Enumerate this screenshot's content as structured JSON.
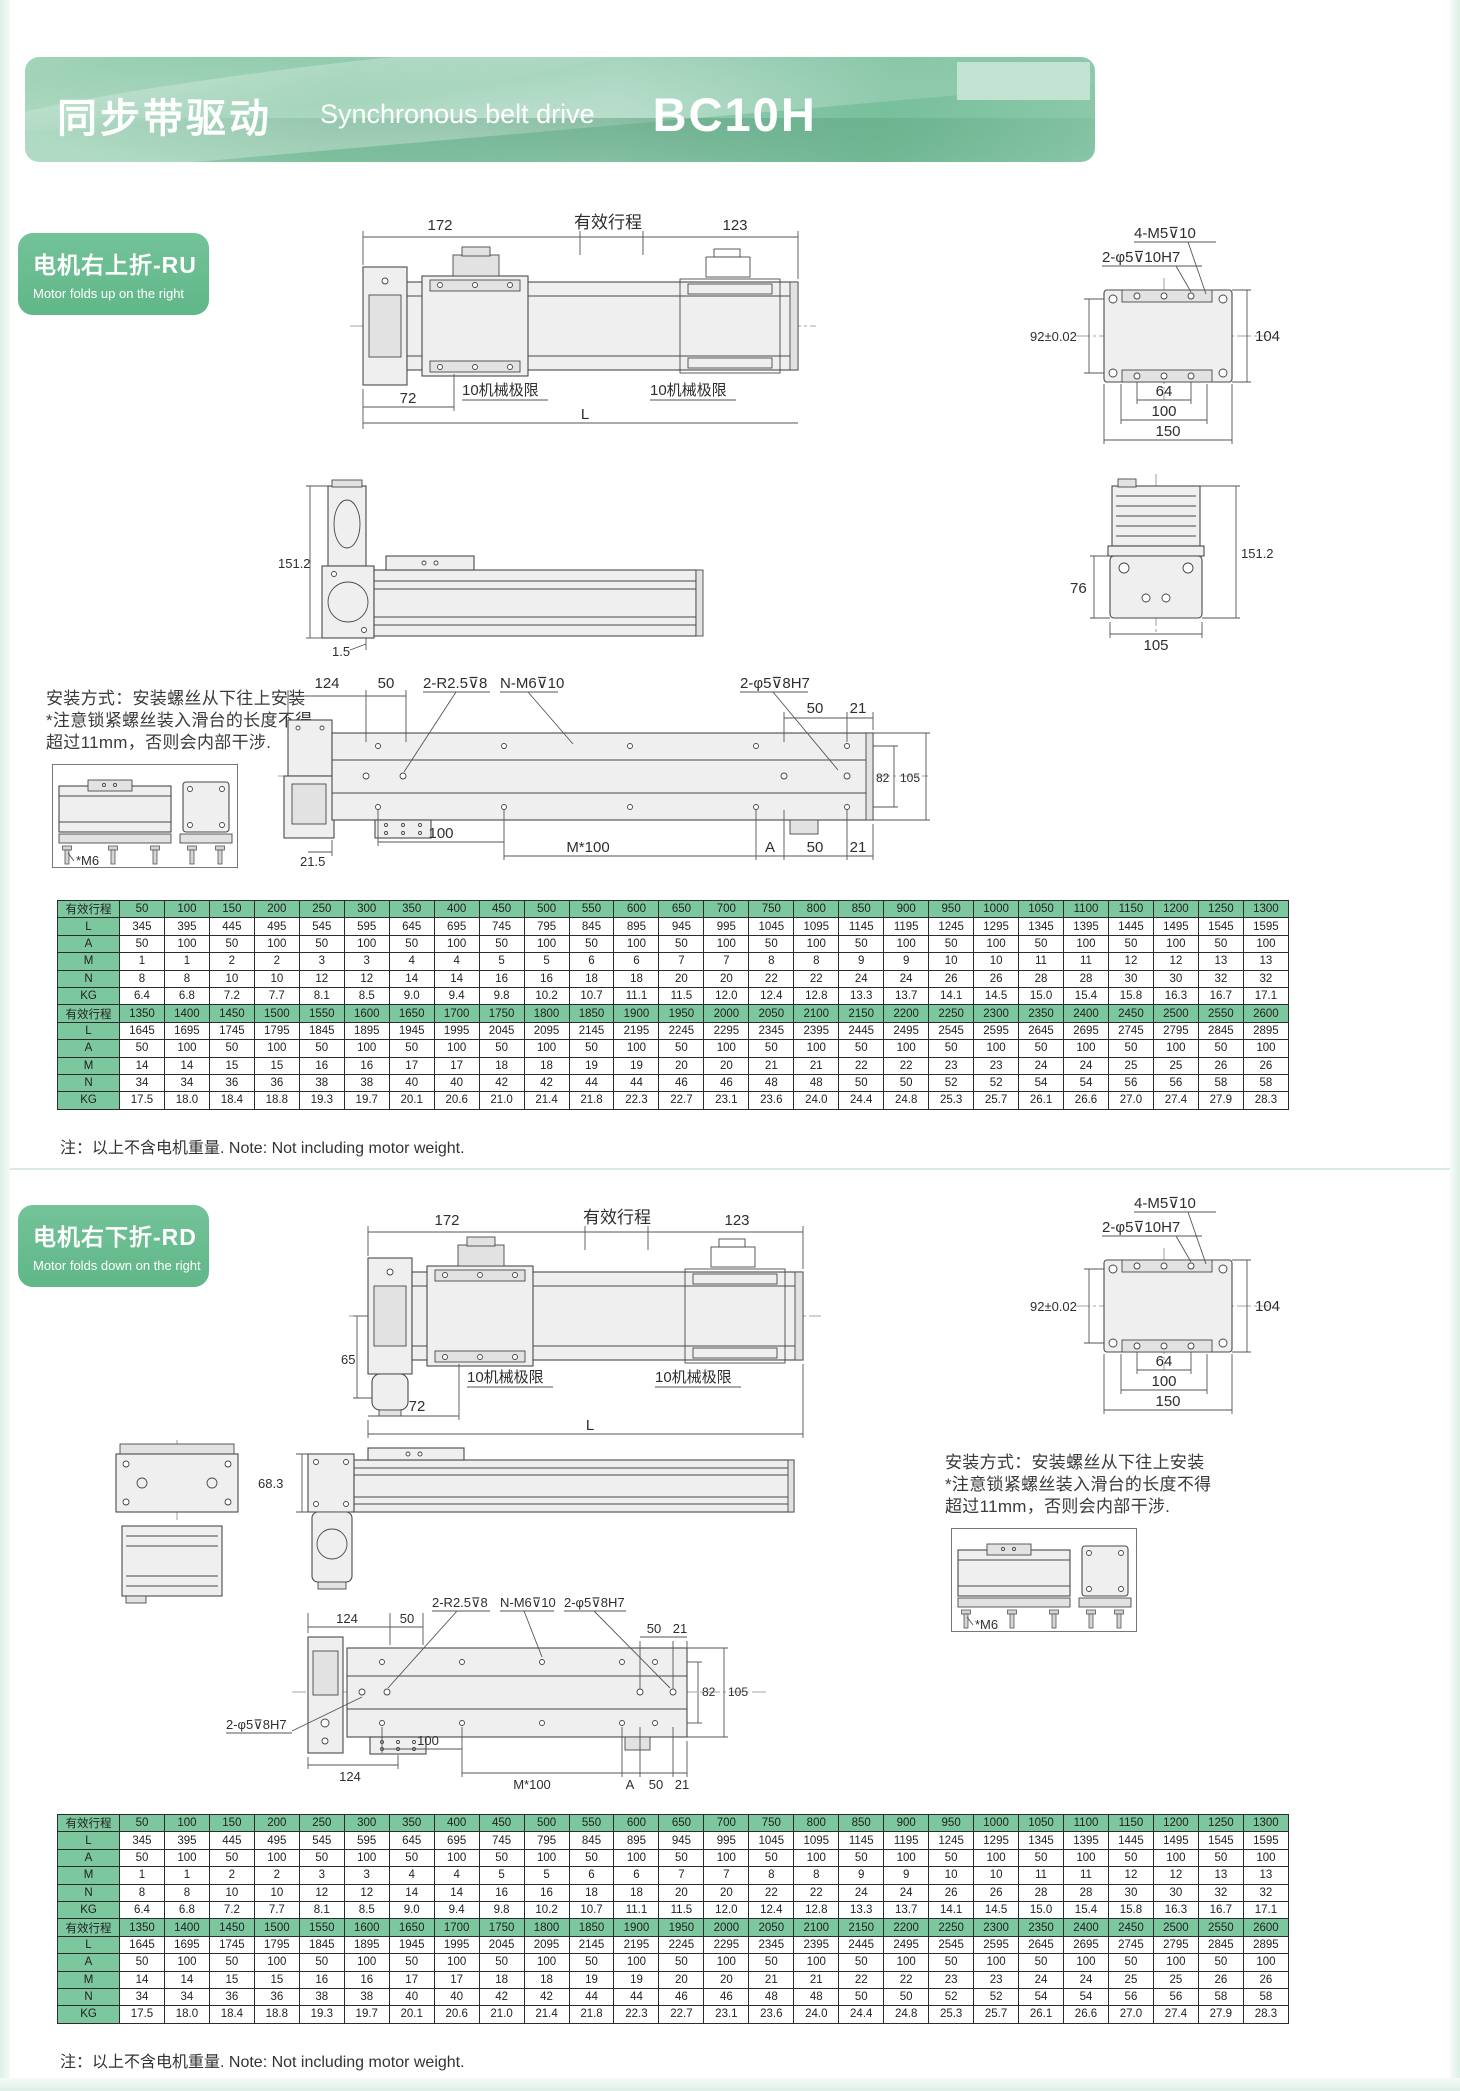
{
  "header": {
    "title_zh": "同步带驱动",
    "title_en": "Synchronous belt drive",
    "model": "BC10H"
  },
  "colors": {
    "banner_green": "#84c5a4",
    "badge_green": "#66bb8e",
    "table_header_green": "#7cc79d"
  },
  "sections": {
    "ru": {
      "badge_zh": "电机右上折-RU",
      "badge_en": "Motor folds up on the right"
    },
    "rd": {
      "badge_zh": "电机右下折-RD",
      "badge_en": "Motor folds down on the right"
    }
  },
  "mount_note": {
    "line1": "安装方式：安装螺丝从下往上安装",
    "line2": "*注意锁紧螺丝装入滑台的长度不得",
    "line3": "超过11mm，否则会内部干涉.",
    "m6": "*M6"
  },
  "dims": {
    "d172": "172",
    "stroke_label": "有效行程",
    "d123": "123",
    "d72": "72",
    "d65": "65",
    "d68_3": "68.3",
    "mech_limit": "10机械极限",
    "L": "L",
    "m5": "4-M5⊽10",
    "phi5_10h7": "2-φ5⊽10H7",
    "d92": "92±0.02",
    "d104": "104",
    "d64": "64",
    "d100": "100",
    "d150": "150",
    "d151_2": "151.2",
    "d1_5": "1.5",
    "d76": "76",
    "d105": "105",
    "d124": "124",
    "d50": "50",
    "d21": "21",
    "d21_5": "21.5",
    "d82": "82",
    "r2_5": "2-R2.5⊽8",
    "nm6": "N-M6⊽10",
    "phi5_8h7": "2-φ5⊽8H7",
    "m_100": "M*100",
    "A": "A"
  },
  "note": "注：以上不含电机重量. Note: Not including motor weight.",
  "table": {
    "row_labels": {
      "stroke": "有效行程",
      "L": "L",
      "A": "A",
      "M": "M",
      "N": "N",
      "KG": "KG"
    },
    "blocks": [
      {
        "stroke": [
          "50",
          "100",
          "150",
          "200",
          "250",
          "300",
          "350",
          "400",
          "450",
          "500",
          "550",
          "600",
          "650",
          "700",
          "750",
          "800",
          "850",
          "900",
          "950",
          "1000",
          "1050",
          "1100",
          "1150",
          "1200",
          "1250",
          "1300"
        ],
        "L": [
          "345",
          "395",
          "445",
          "495",
          "545",
          "595",
          "645",
          "695",
          "745",
          "795",
          "845",
          "895",
          "945",
          "995",
          "1045",
          "1095",
          "1145",
          "1195",
          "1245",
          "1295",
          "1345",
          "1395",
          "1445",
          "1495",
          "1545",
          "1595"
        ],
        "A": [
          "50",
          "100",
          "50",
          "100",
          "50",
          "100",
          "50",
          "100",
          "50",
          "100",
          "50",
          "100",
          "50",
          "100",
          "50",
          "100",
          "50",
          "100",
          "50",
          "100",
          "50",
          "100",
          "50",
          "100",
          "50",
          "100"
        ],
        "M": [
          "1",
          "1",
          "2",
          "2",
          "3",
          "3",
          "4",
          "4",
          "5",
          "5",
          "6",
          "6",
          "7",
          "7",
          "8",
          "8",
          "9",
          "9",
          "10",
          "10",
          "11",
          "11",
          "12",
          "12",
          "13",
          "13"
        ],
        "N": [
          "8",
          "8",
          "10",
          "10",
          "12",
          "12",
          "14",
          "14",
          "16",
          "16",
          "18",
          "18",
          "20",
          "20",
          "22",
          "22",
          "24",
          "24",
          "26",
          "26",
          "28",
          "28",
          "30",
          "30",
          "32",
          "32"
        ],
        "KG": [
          "6.4",
          "6.8",
          "7.2",
          "7.7",
          "8.1",
          "8.5",
          "9.0",
          "9.4",
          "9.8",
          "10.2",
          "10.7",
          "11.1",
          "11.5",
          "12.0",
          "12.4",
          "12.8",
          "13.3",
          "13.7",
          "14.1",
          "14.5",
          "15.0",
          "15.4",
          "15.8",
          "16.3",
          "16.7",
          "17.1"
        ]
      },
      {
        "stroke": [
          "1350",
          "1400",
          "1450",
          "1500",
          "1550",
          "1600",
          "1650",
          "1700",
          "1750",
          "1800",
          "1850",
          "1900",
          "1950",
          "2000",
          "2050",
          "2100",
          "2150",
          "2200",
          "2250",
          "2300",
          "2350",
          "2400",
          "2450",
          "2500",
          "2550",
          "2600"
        ],
        "L": [
          "1645",
          "1695",
          "1745",
          "1795",
          "1845",
          "1895",
          "1945",
          "1995",
          "2045",
          "2095",
          "2145",
          "2195",
          "2245",
          "2295",
          "2345",
          "2395",
          "2445",
          "2495",
          "2545",
          "2595",
          "2645",
          "2695",
          "2745",
          "2795",
          "2845",
          "2895"
        ],
        "A": [
          "50",
          "100",
          "50",
          "100",
          "50",
          "100",
          "50",
          "100",
          "50",
          "100",
          "50",
          "100",
          "50",
          "100",
          "50",
          "100",
          "50",
          "100",
          "50",
          "100",
          "50",
          "100",
          "50",
          "100",
          "50",
          "100"
        ],
        "M": [
          "14",
          "14",
          "15",
          "15",
          "16",
          "16",
          "17",
          "17",
          "18",
          "18",
          "19",
          "19",
          "20",
          "20",
          "21",
          "21",
          "22",
          "22",
          "23",
          "23",
          "24",
          "24",
          "25",
          "25",
          "26",
          "26"
        ],
        "N": [
          "34",
          "34",
          "36",
          "36",
          "38",
          "38",
          "40",
          "40",
          "42",
          "42",
          "44",
          "44",
          "46",
          "46",
          "48",
          "48",
          "50",
          "50",
          "52",
          "52",
          "54",
          "54",
          "56",
          "56",
          "58",
          "58"
        ],
        "KG": [
          "17.5",
          "18.0",
          "18.4",
          "18.8",
          "19.3",
          "19.7",
          "20.1",
          "20.6",
          "21.0",
          "21.4",
          "21.8",
          "22.3",
          "22.7",
          "23.1",
          "23.6",
          "24.0",
          "24.4",
          "24.8",
          "25.3",
          "25.7",
          "26.1",
          "26.6",
          "27.0",
          "27.4",
          "27.9",
          "28.3"
        ]
      }
    ]
  }
}
